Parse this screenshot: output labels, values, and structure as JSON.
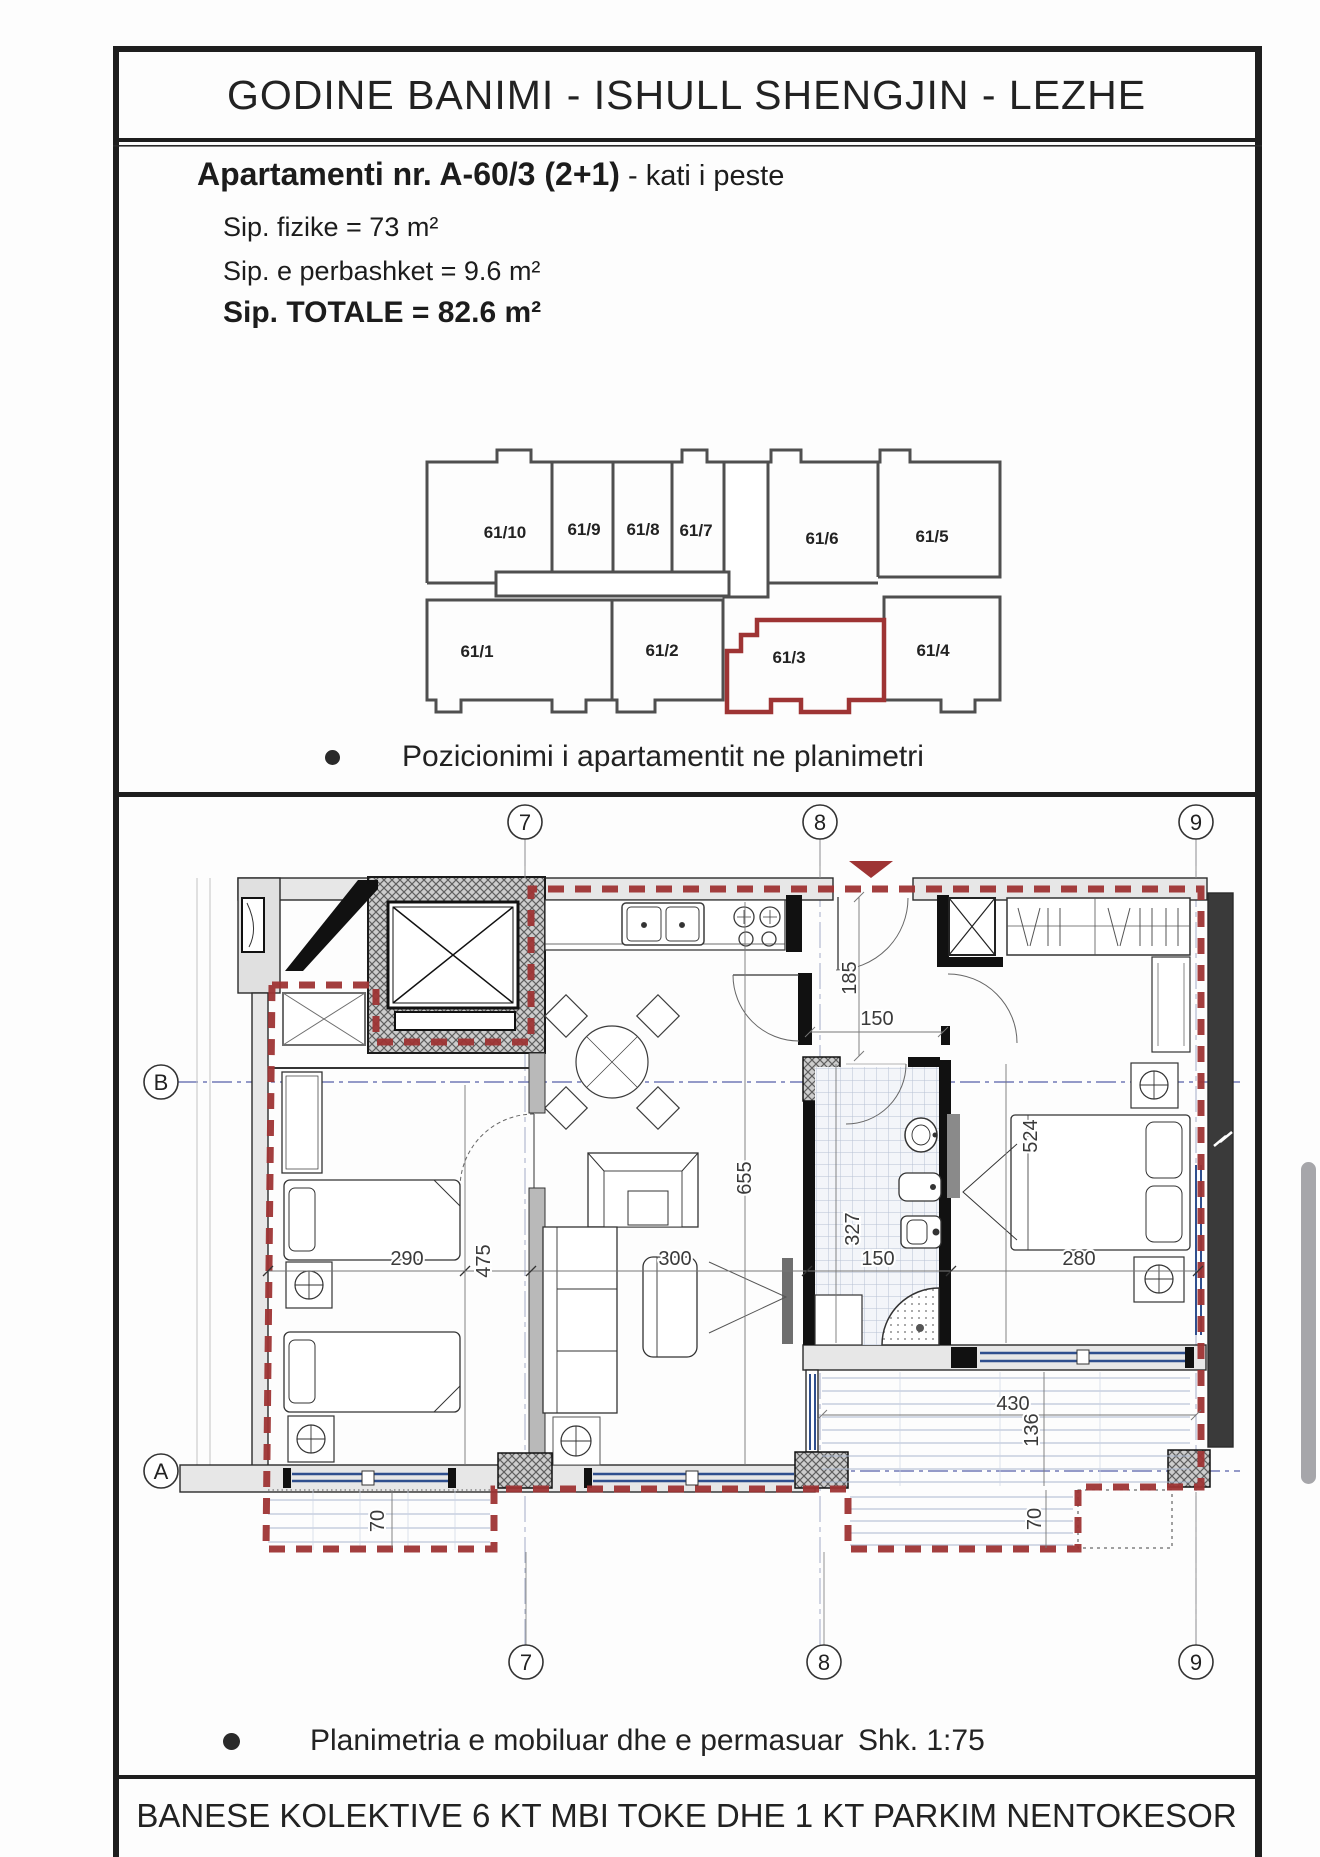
{
  "page": {
    "title": "GODINE BANIMI - ISHULL SHENGJIN - LEZHE",
    "footer": "BANESE KOLEKTIVE 6 KT MBI TOKE  DHE 1 KT PARKIM NENTOKESOR"
  },
  "apartment_info": {
    "heading_bold": "Apartamenti nr. A-60/3 (2+1)",
    "heading_suffix": " - kati i peste",
    "area_physical": "Sip. fizike = 73 m²",
    "area_common": "Sip. e perbashket = 9.6 m²",
    "area_total": "Sip. TOTALE = 82.6 m²"
  },
  "position_diagram": {
    "caption": "Pozicionimi i apartamentit ne planimetri",
    "highlighted_unit": "61/3",
    "units_top": [
      "61/10",
      "61/9",
      "61/8",
      "61/7",
      "61/6",
      "61/5"
    ],
    "units_bottom": [
      "61/1",
      "61/2",
      "61/3",
      "61/4"
    ]
  },
  "floor_plan": {
    "caption": "Planimetria e mobiluar dhe e permasuar",
    "scale_label": "Shk. 1:75",
    "grid_columns": [
      "7",
      "8",
      "9"
    ],
    "grid_rows": [
      "B",
      "A"
    ],
    "dimensions": {
      "hall_depth": "185",
      "door_width": "150",
      "living_depth": "655",
      "bath_depth": "327",
      "bed1_width": "290",
      "bed1_depth": "475",
      "living_width": "300",
      "bath_width": "150",
      "bed2_width": "280",
      "bed2_depth": "524",
      "terrace_width": "430",
      "terrace_depth": "136",
      "balcony_left_depth": "70",
      "balcony_right_depth": "70"
    }
  },
  "colors": {
    "boundary_red": "#9e3434",
    "grid_blue": "#5560a8",
    "window_blue": "#2f4f8e"
  }
}
